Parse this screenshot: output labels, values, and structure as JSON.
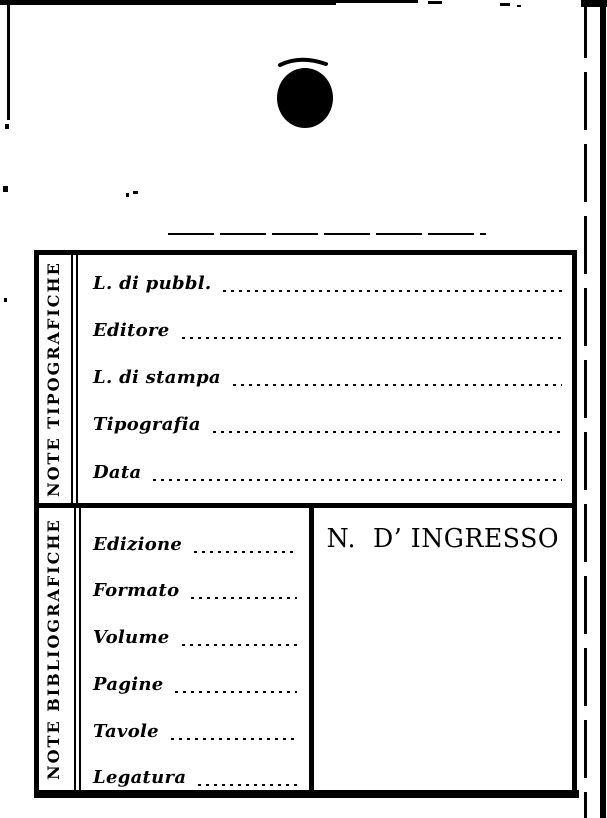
{
  "scan": {
    "paper_color": "#ffffff",
    "ink_color": "#000000"
  },
  "card": {
    "typographic_section": {
      "side_label": "NOTE TIPOGRAFICHE",
      "fields": [
        {
          "label": "L. di pubbl.",
          "value": ""
        },
        {
          "label": "Editore",
          "value": ""
        },
        {
          "label": "L. di stampa",
          "value": ""
        },
        {
          "label": "Tipografia",
          "value": ""
        },
        {
          "label": "Data",
          "value": ""
        }
      ]
    },
    "bibliographic_section": {
      "side_label": "NOTE BIBLIOGRAFICHE",
      "fields": [
        {
          "label": "Edizione",
          "value": ""
        },
        {
          "label": "Formato",
          "value": ""
        },
        {
          "label": "Volume",
          "value": ""
        },
        {
          "label": "Pagine",
          "value": ""
        },
        {
          "label": "Tavole",
          "value": ""
        },
        {
          "label": "Legatura",
          "value": ""
        }
      ],
      "accession_label": "N.  D’ INGRESSO",
      "accession_value": ""
    }
  }
}
